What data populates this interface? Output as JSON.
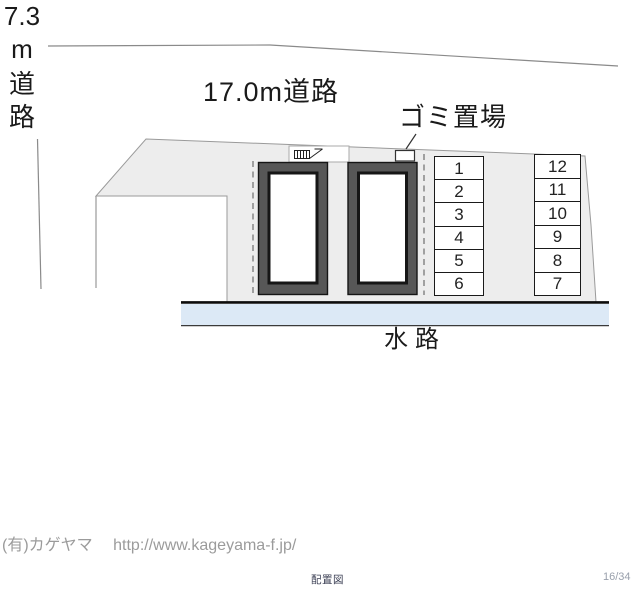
{
  "plan": {
    "road_top_label": "17.0m道路",
    "road_left_label": [
      "7.3",
      "m",
      "道",
      "路"
    ],
    "garbage_label": "ゴミ置場",
    "waterway_label": "水路",
    "parking_left": [
      "1",
      "2",
      "3",
      "4",
      "5",
      "6"
    ],
    "parking_right": [
      "12",
      "11",
      "10",
      "9",
      "8",
      "7"
    ],
    "icons": [
      "stairs-hatch-icon",
      "garbage-box-icon",
      "garbage-pointer-line"
    ]
  },
  "footer": {
    "company": "(有)カゲヤマ",
    "url": "http://www.kageyama-f.jp/"
  },
  "statusbar": {
    "caption": "配置図",
    "page_indicator": "16/34"
  },
  "colors": {
    "parcel_fill": "#ededed",
    "building_frame": "#575757",
    "building_outline": "#161616",
    "waterway_fill": "#dce9f6",
    "boundary_line": "#8a8a8a",
    "footer_text": "#9b9b9b",
    "caption_text": "#3d4156",
    "page_indicator_text": "#99a0ac"
  }
}
